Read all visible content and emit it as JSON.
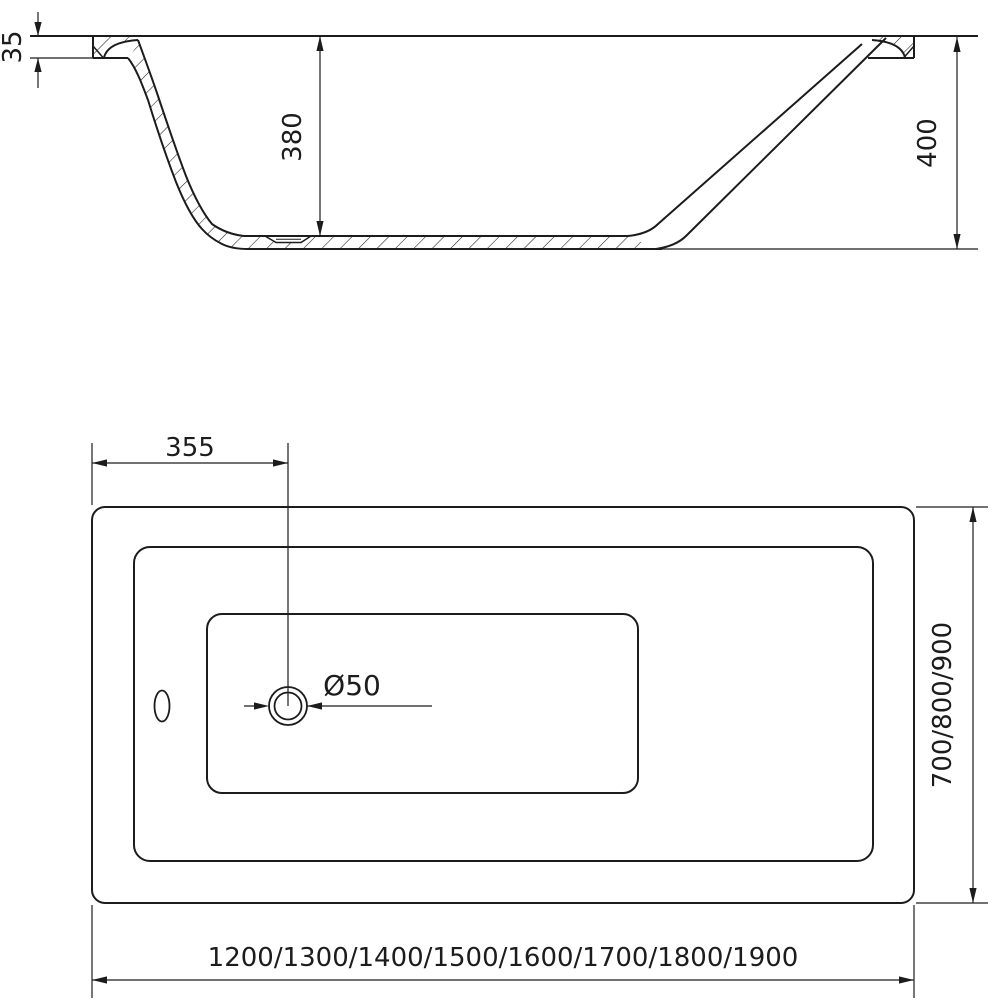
{
  "page": {
    "background": "#ffffff",
    "line_color": "#1c1c1c",
    "description": "Technical dimension drawing of a rectangular bathtub: side cross-section and top plan view"
  },
  "views": {
    "side_section": {
      "label": "side cross-section",
      "dimensions": {
        "rim_thickness": "35",
        "inner_depth": "380",
        "overall_height": "400"
      }
    },
    "top_plan": {
      "label": "top plan",
      "dimensions": {
        "drain_center_offset": "355",
        "drain_diameter": "Ø50",
        "width_variants": "700/800/900",
        "length_variants": "1200/1300/1400/1500/1600/1700/1800/1900"
      }
    }
  }
}
